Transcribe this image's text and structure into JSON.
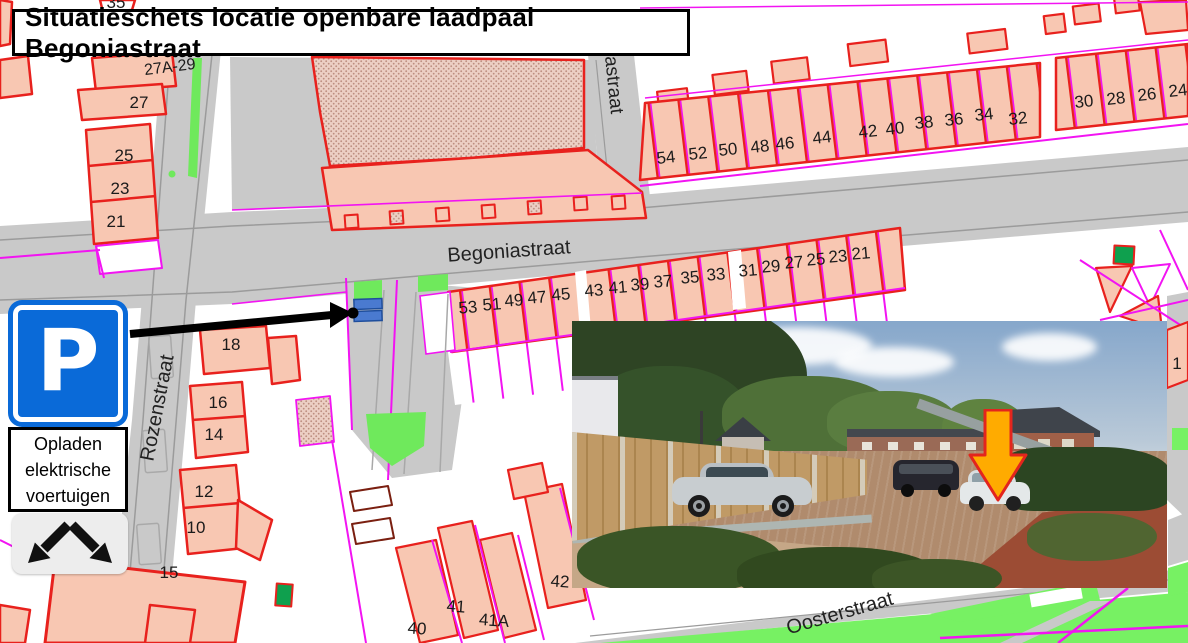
{
  "title": "Situatieschets locatie openbare laadpaal Begoniastraat",
  "parking_sign": {
    "symbol": "P",
    "caption_lines": [
      "Opladen",
      "elektrische",
      "voertuigen"
    ]
  },
  "colors": {
    "map_magenta": "#f214f2",
    "map_red": "#e8211d",
    "building_fill": "#f8c7b2",
    "road_gray": "#c9c9c9",
    "grass_green": "#77f163",
    "dark_green_building": "#0fa04e",
    "sign_blue": "#0a6ad8",
    "charging_spot_blue": "#4a7ad0",
    "photo_arrow_orange": "#ffab00",
    "photo_arrow_border": "#e3251d"
  },
  "map": {
    "labels": [
      {
        "text": "Begoniastraat",
        "x": 509,
        "y": 252,
        "rot": -4,
        "size": 20,
        "cls": "street",
        "name": "street-label-begoniastraat"
      },
      {
        "text": "Rozenstraat",
        "x": 158,
        "y": 408,
        "rot": -79,
        "size": 20,
        "cls": "street",
        "name": "street-label-rozenstraat"
      },
      {
        "text": "Oosterstraat",
        "x": 840,
        "y": 614,
        "rot": -16,
        "size": 20,
        "cls": "street",
        "name": "street-label-oosterstraat"
      },
      {
        "text": "astraat",
        "x": 613,
        "y": 85,
        "rot": 84,
        "size": 19,
        "cls": "street",
        "name": "street-label-astraat-partial"
      },
      {
        "text": "54",
        "x": 666,
        "y": 158,
        "rot": -6
      },
      {
        "text": "52",
        "x": 698,
        "y": 154,
        "rot": -6
      },
      {
        "text": "50",
        "x": 728,
        "y": 150,
        "rot": -6
      },
      {
        "text": "48",
        "x": 760,
        "y": 147,
        "rot": -6
      },
      {
        "text": "46",
        "x": 785,
        "y": 144,
        "rot": -6
      },
      {
        "text": "44",
        "x": 822,
        "y": 138,
        "rot": -6
      },
      {
        "text": "42",
        "x": 868,
        "y": 132,
        "rot": -6
      },
      {
        "text": "40",
        "x": 895,
        "y": 129,
        "rot": -6
      },
      {
        "text": "38",
        "x": 924,
        "y": 123,
        "rot": -6
      },
      {
        "text": "36",
        "x": 954,
        "y": 120,
        "rot": -6
      },
      {
        "text": "34",
        "x": 984,
        "y": 115,
        "rot": -6
      },
      {
        "text": "32",
        "x": 1018,
        "y": 119,
        "rot": -6
      },
      {
        "text": "30",
        "x": 1084,
        "y": 102,
        "rot": -6
      },
      {
        "text": "28",
        "x": 1116,
        "y": 99,
        "rot": -6
      },
      {
        "text": "26",
        "x": 1147,
        "y": 95,
        "rot": -6
      },
      {
        "text": "24",
        "x": 1178,
        "y": 91,
        "rot": -6
      },
      {
        "text": "53",
        "x": 468,
        "y": 308,
        "rot": -5
      },
      {
        "text": "51",
        "x": 492,
        "y": 305,
        "rot": -5
      },
      {
        "text": "49",
        "x": 514,
        "y": 301,
        "rot": -5
      },
      {
        "text": "47",
        "x": 537,
        "y": 298,
        "rot": -5
      },
      {
        "text": "45",
        "x": 561,
        "y": 295,
        "rot": -5
      },
      {
        "text": "43",
        "x": 594,
        "y": 291,
        "rot": -5
      },
      {
        "text": "41",
        "x": 618,
        "y": 288,
        "rot": -5
      },
      {
        "text": "39",
        "x": 640,
        "y": 285,
        "rot": -5
      },
      {
        "text": "37",
        "x": 663,
        "y": 282,
        "rot": -5
      },
      {
        "text": "35",
        "x": 690,
        "y": 278,
        "rot": -5
      },
      {
        "text": "33",
        "x": 716,
        "y": 275,
        "rot": -5
      },
      {
        "text": "31",
        "x": 748,
        "y": 271,
        "rot": -5
      },
      {
        "text": "29",
        "x": 771,
        "y": 267,
        "rot": -5
      },
      {
        "text": "27",
        "x": 794,
        "y": 263,
        "rot": -5
      },
      {
        "text": "25",
        "x": 816,
        "y": 260,
        "rot": -5
      },
      {
        "text": "23",
        "x": 838,
        "y": 257,
        "rot": -5
      },
      {
        "text": "21",
        "x": 861,
        "y": 254,
        "rot": -5
      },
      {
        "text": "27A-29",
        "x": 170,
        "y": 68,
        "rot": -7,
        "size": 16
      },
      {
        "text": "27",
        "x": 139,
        "y": 103
      },
      {
        "text": "25",
        "x": 124,
        "y": 156
      },
      {
        "text": "23",
        "x": 120,
        "y": 189
      },
      {
        "text": "21",
        "x": 116,
        "y": 222
      },
      {
        "text": "18",
        "x": 231,
        "y": 345
      },
      {
        "text": "16",
        "x": 218,
        "y": 403
      },
      {
        "text": "14",
        "x": 214,
        "y": 435
      },
      {
        "text": "12",
        "x": 204,
        "y": 492
      },
      {
        "text": "10",
        "x": 196,
        "y": 528
      },
      {
        "text": "15",
        "x": 169,
        "y": 573
      },
      {
        "text": "42",
        "x": 560,
        "y": 582,
        "rot": 4
      },
      {
        "text": "41",
        "x": 456,
        "y": 607,
        "rot": 4
      },
      {
        "text": "41A",
        "x": 494,
        "y": 621,
        "rot": 4
      },
      {
        "text": "40",
        "x": 417,
        "y": 629,
        "rot": 4
      },
      {
        "text": "35",
        "x": 116,
        "y": 3
      },
      {
        "text": "1",
        "x": 1177,
        "y": 364
      }
    ]
  }
}
